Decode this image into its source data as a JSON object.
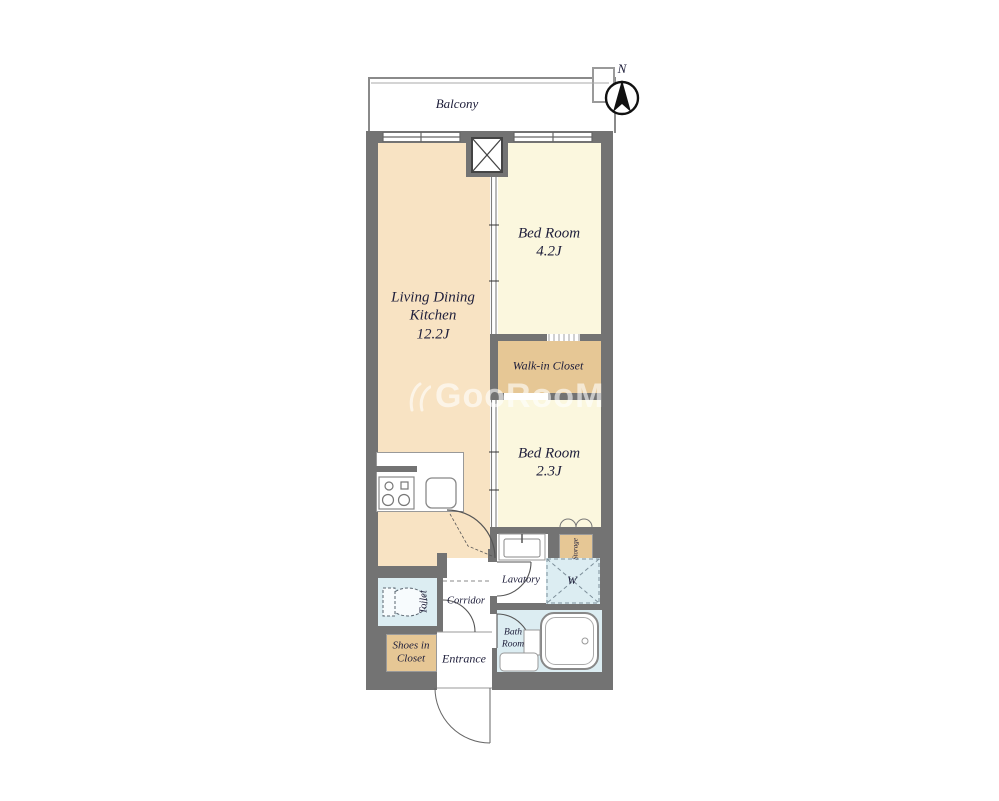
{
  "compass": {
    "north_label": "N"
  },
  "balcony": {
    "label": "Balcony"
  },
  "rooms": {
    "ldk": {
      "name": "Living Dining Kitchen",
      "size": "12.2J"
    },
    "bedroom_1": {
      "name": "Bed Room",
      "size": "4.2J"
    },
    "bedroom_2": {
      "name": "Bed Room",
      "size": "2.3J"
    },
    "walk_in_closet": {
      "label": "Walk-in Closet"
    },
    "storage": {
      "label": "Storage"
    },
    "lavatory": {
      "label": "Lavatory"
    },
    "washing_machine": {
      "label": "W"
    },
    "bath_room": {
      "label": "Bath Room"
    },
    "toilet": {
      "label": "Toilet"
    },
    "corridor": {
      "label": "Corridor"
    },
    "shoes_in_closet": {
      "label": "Shoes in Closet"
    },
    "entrance": {
      "label": "Entrance"
    }
  },
  "watermark": {
    "text": "GooRooM"
  },
  "colors": {
    "ldk_floor": "#f8e3c3",
    "bedroom_floor": "#fbf7de",
    "closet_tan": "#e6c795",
    "wet_area_blue": "#dcedf2",
    "wall_gray": "#737373",
    "label_ink": "#20203c"
  }
}
